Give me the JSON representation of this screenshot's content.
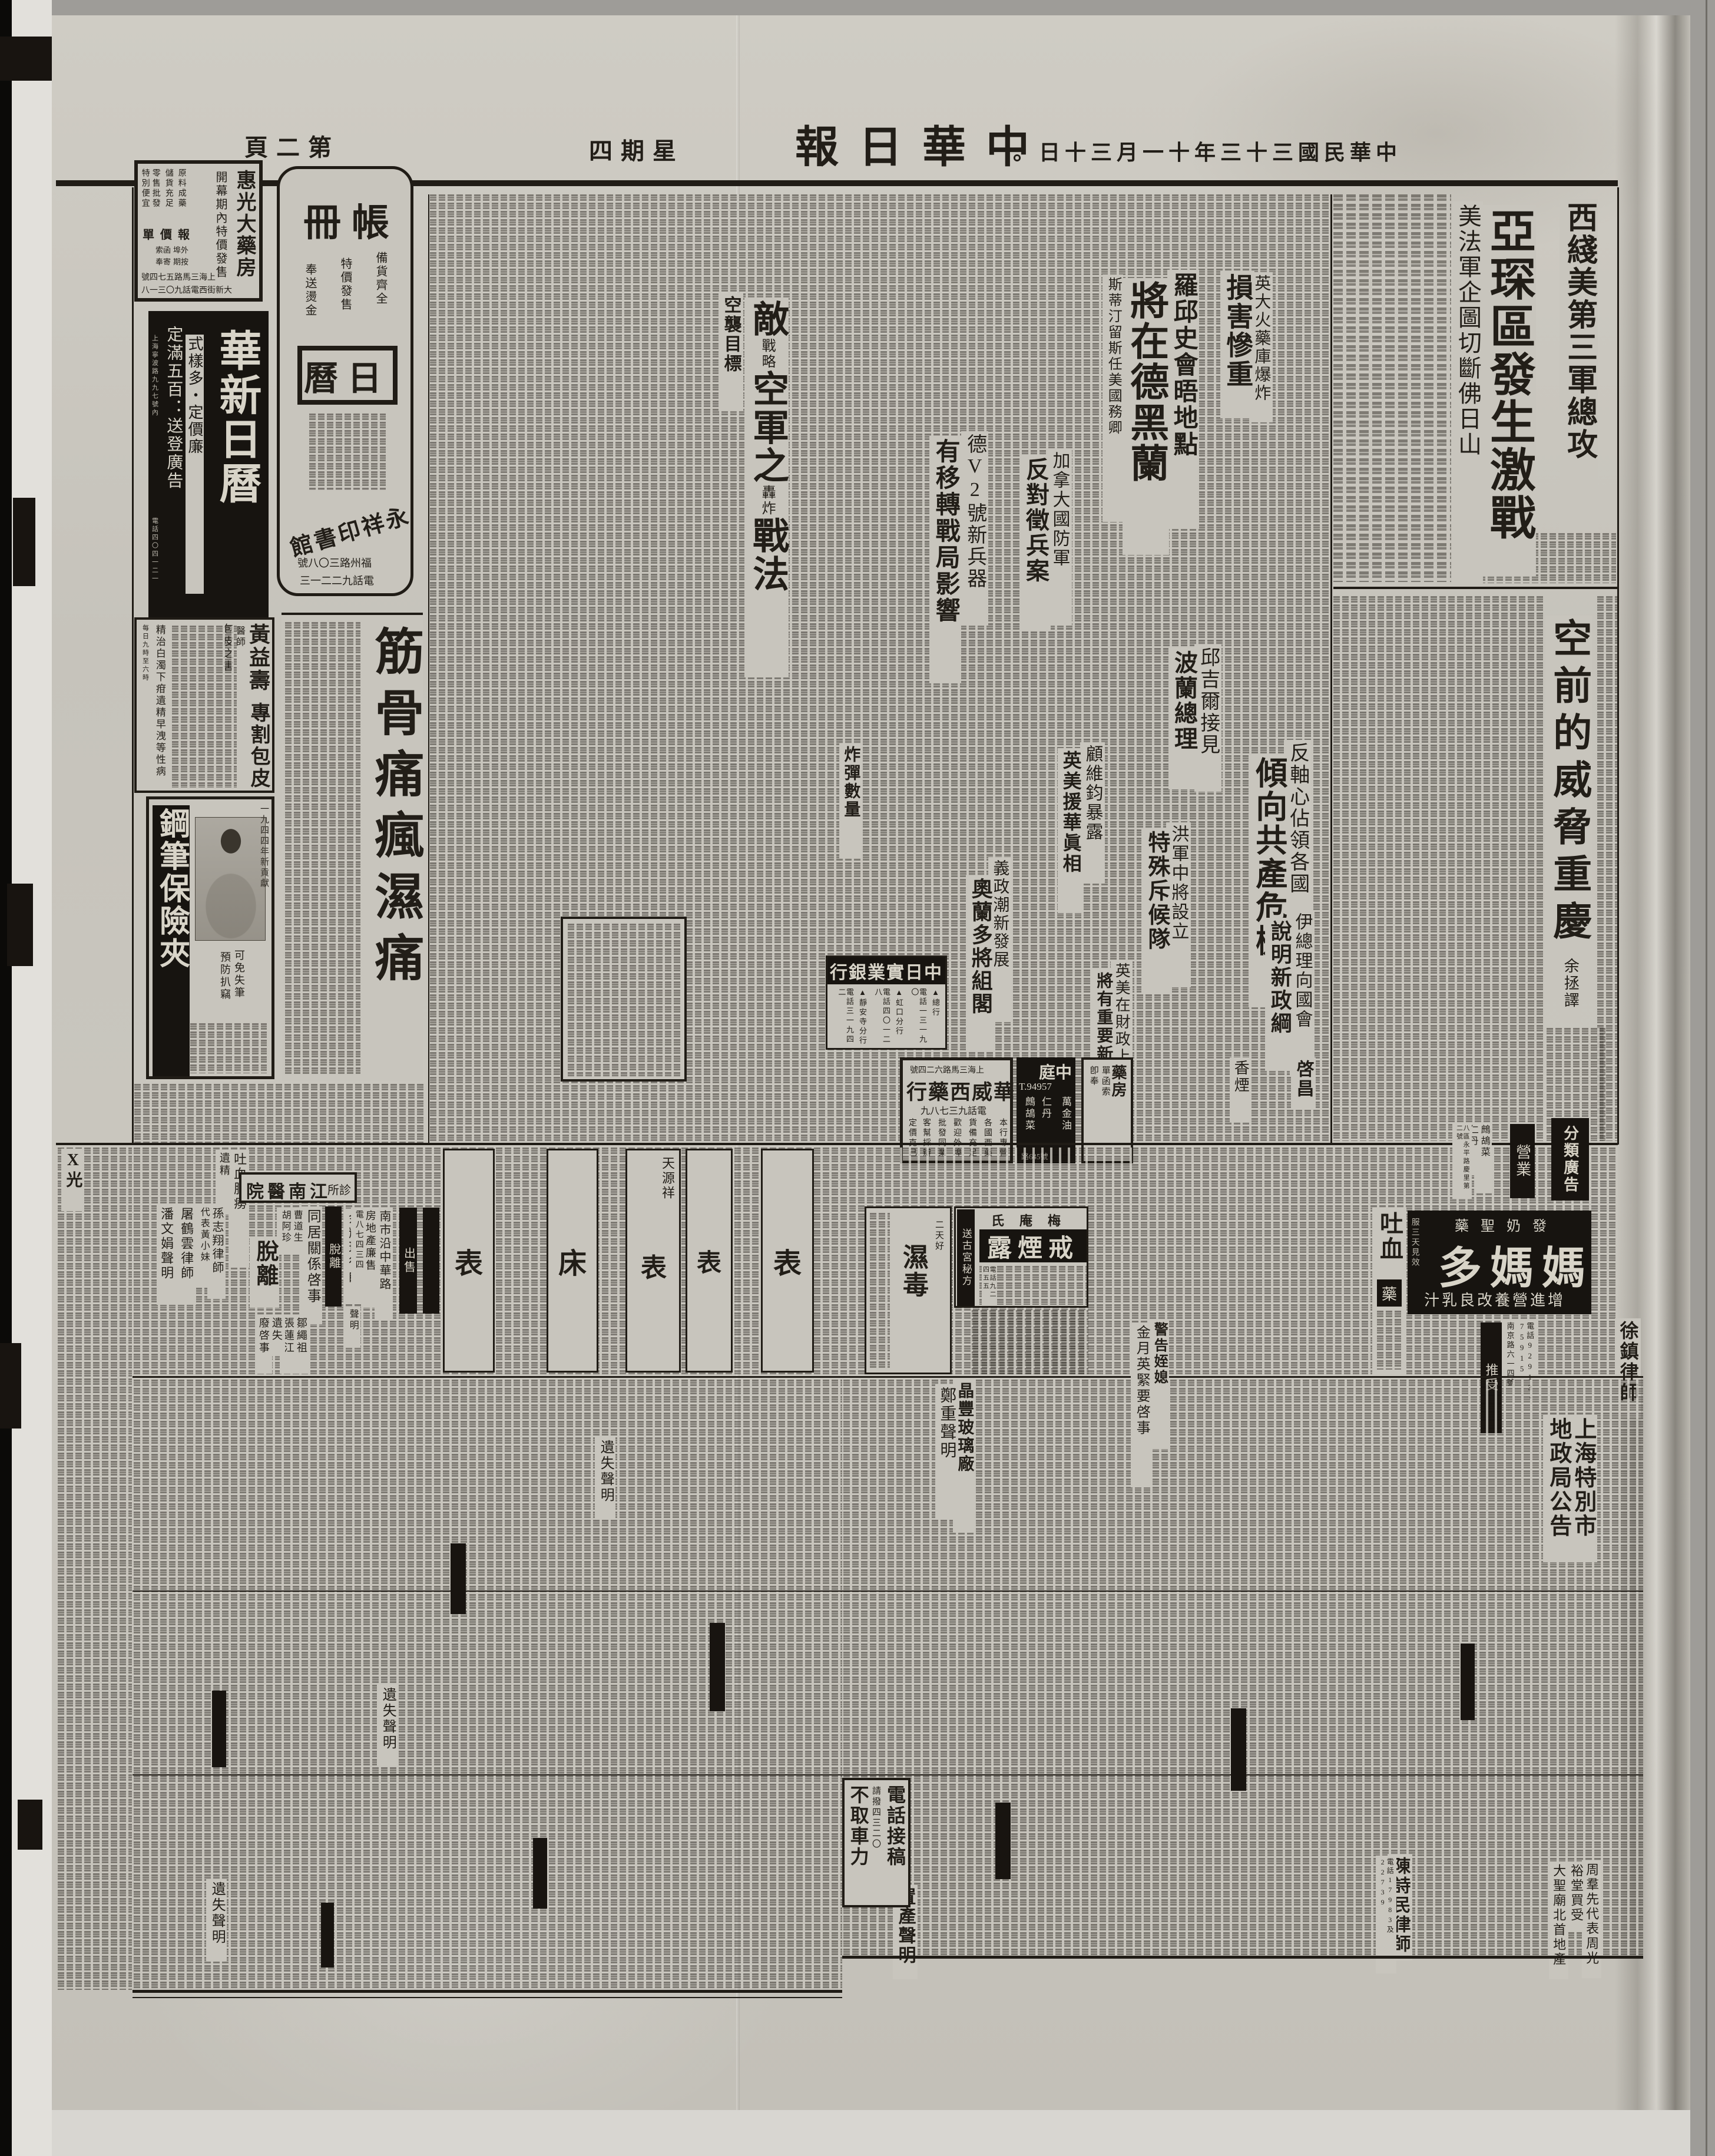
{
  "page": {
    "title": "中華日報",
    "date": "中華民國三十三年十一月三十日。",
    "weekday": "星期四",
    "page_no": "第二頁"
  },
  "lead": {
    "kicker": "西綫美第三軍總攻",
    "headline": "亞琛區發生激戰",
    "deck": "美法軍企圖切斷佛日山"
  },
  "feature": {
    "title": "空前的威脅重慶",
    "byline": "余拯譯"
  },
  "news": {
    "tehran_kicker": "羅邱史會晤地點",
    "tehran_title": "將在德黑蘭",
    "tehran_sub": "斯蒂汀留斯任美國務卿",
    "powder_kicker": "英大火藥庫爆炸",
    "powder_title": "損害慘重",
    "v2_kicker": "德V2號新兵器",
    "v2_title": "有移轉戰局影響",
    "canada_kicker": "加拿大國防軍",
    "canada_title": "反對徵兵案",
    "air_main1": "敵",
    "air_anno1": "戰略",
    "air_main2": "空軍之",
    "air_anno2": "轟炸",
    "air_main3": "戰法",
    "air_sub1": "空襲目標",
    "air_sub2": "炸彈數量",
    "churchill_kicker": "邱吉爾接見",
    "churchill_title": "波蘭總理",
    "axis_kicker": "反軸心佔領各國",
    "axis_title": "傾向共產危機",
    "koo_kicker": "顧維鈞暴露",
    "koo_title": "英美援華眞相",
    "italy_kicker": "義政潮新發展",
    "italy_title": "奧蘭多將組閣",
    "scout_kicker": "洪軍中將設立",
    "scout_title": "特殊斥候隊",
    "iran_kicker": "伊總理向國會",
    "iran_title": "說明新政綱",
    "finance_kicker": "英美在財政上",
    "finance_title": "將有重要新發展"
  },
  "ads": {
    "huiguang": {
      "name": "惠光大藥房",
      "promo": "開幕期內特價發售",
      "p1": "原料成藥",
      "p2": "儲貨充足",
      "p3": "零售批發",
      "p4": "特別便宜",
      "quote": "報價單",
      "q1": "外埠",
      "q2": "函索",
      "q3": "按期",
      "q4": "寄奉",
      "addr1": "上海三馬路五七四號",
      "addr2": "大新街西電話九〇三一八"
    },
    "ledger": {
      "name": "帳冊",
      "p1": "備貨齊全",
      "p2": "特價發售",
      "p3": "奉送燙金",
      "product": "日曆",
      "publisher": "永祥印書館",
      "addr": "福州路三〇八號",
      "phone": "電話九二二一三"
    },
    "huaxin": {
      "name": "華新日曆",
      "tag1": "式樣多・定價廉",
      "tag2": "定滿五百：送登廣告",
      "addr": "上海寧波路九九七號內",
      "phone": "電話四〇四一二一"
    },
    "huang": {
      "name": "黃益壽",
      "title": "醫師",
      "service": "專割包皮",
      "harm": "包皮之害",
      "note": "精治白濁下疳遺精早洩等性病",
      "hours": "每日九時至六時"
    },
    "pen": {
      "name": "鋼筆保險夾",
      "year": "一九四四年新貢獻",
      "t1": "可免失筆",
      "t2": "預防扒竊"
    },
    "paste": {
      "name": "筋骨痛瘋濕痛"
    },
    "bank": {
      "name": "中日實業銀行",
      "b1": "▲總行",
      "p1": "電話一三一九〇",
      "b2": "▲虹口分行",
      "p2": "電話四〇一二八",
      "b3": "▲靜安寺分行",
      "p3": "電話三一九四二"
    },
    "huawei": {
      "addr": "上海三馬路六二四號",
      "name": "華威西藥行",
      "phone": "電話九三七八九",
      "d1": "本行專營",
      "d2": "各國西藥",
      "d3": "貨備充足",
      "d4": "歡迎外埠",
      "d5": "批發同業",
      "d6": "客幫採辦",
      "d7": "定價克己"
    },
    "zhongting": {
      "name": "中庭",
      "phone": "T.94957",
      "i1": "萬金油",
      "i2": "仁丹",
      "i3": "鷓鴣菜",
      "addr": "路645號"
    },
    "mama": {
      "tag": "發奶聖藥",
      "name": "媽媽多",
      "tagline": "增進營養改良乳汁",
      "side": "服三天見效"
    },
    "smoke": {
      "brand": "梅庵氏",
      "name": "戒煙露",
      "side": "送古宮秘方",
      "phone": "電話九二四五五"
    },
    "damp": {
      "name": "濕毒",
      "side": "二天好"
    },
    "blood": {
      "name": "吐血",
      "unit": "藥"
    },
    "lung": {
      "name": "吐血肺癆",
      "sub": "遺精"
    },
    "xray": {
      "name": "X光"
    },
    "hospital": {
      "name": "江南醫院",
      "sub": "診所"
    },
    "watch": {
      "w": "表",
      "bed": "床",
      "shop": "天源祥"
    },
    "qichang": {
      "name": "啓昌"
    },
    "cigarette": {
      "name": "香煙"
    },
    "pharmacy": {
      "name": "藥房",
      "note1": "單函索",
      "note2": "卽奉"
    },
    "zhege": {
      "i1": "鷓鴣菜",
      "i2": "仁丹",
      "addr": "八區永平路慶里第二號"
    }
  },
  "classified": {
    "header": "分類廣告",
    "biz": "營業",
    "lab_detach": "脫離",
    "lab_sale": "出售",
    "lab_accept": "推受",
    "xu_title": "徐鎮律師",
    "xu_phone": "電話92913・75915",
    "xu_addr": "南京路六一四號",
    "yu_title": "余耀球律師",
    "yu_sub": "聲明",
    "yu_big": "脫離",
    "cohabit": "同居關係啓事",
    "cohabit_n1": "曹道生",
    "cohabit_n2": "胡阿珍",
    "sun": "孫志翔律師",
    "sun_sub": "代表黃小妹",
    "pan": "潘文娟聲明",
    "tu": "屠鶴雲律師",
    "estate": "南市沿中華路",
    "estate2": "房地產廉售",
    "estate_phone": "電八七四三四",
    "warn": "警告姪媳",
    "warn2": "金月英緊要啓事",
    "glass": "晶豐玻璃廠",
    "glass2": "鄭重聲明",
    "land1": "上海特別市",
    "land2": "地政局公告",
    "chen": "陳詩民律師",
    "chen_phone": "電話17983及22739",
    "zhou1": "周羣先代表周光",
    "zhou2": "裕堂買受",
    "zhou3": "大聖廟北首地產",
    "zou": "鄒繩祖",
    "zhang": "張蓮江",
    "lost": "遺失",
    "fei": "廢啓事",
    "zhichan": "置產聲明",
    "lost_stmt": "遺失聲明"
  },
  "promo": {
    "l1": "電話接稿",
    "l2": "請撥四三二〇",
    "l3": "不取車力"
  }
}
